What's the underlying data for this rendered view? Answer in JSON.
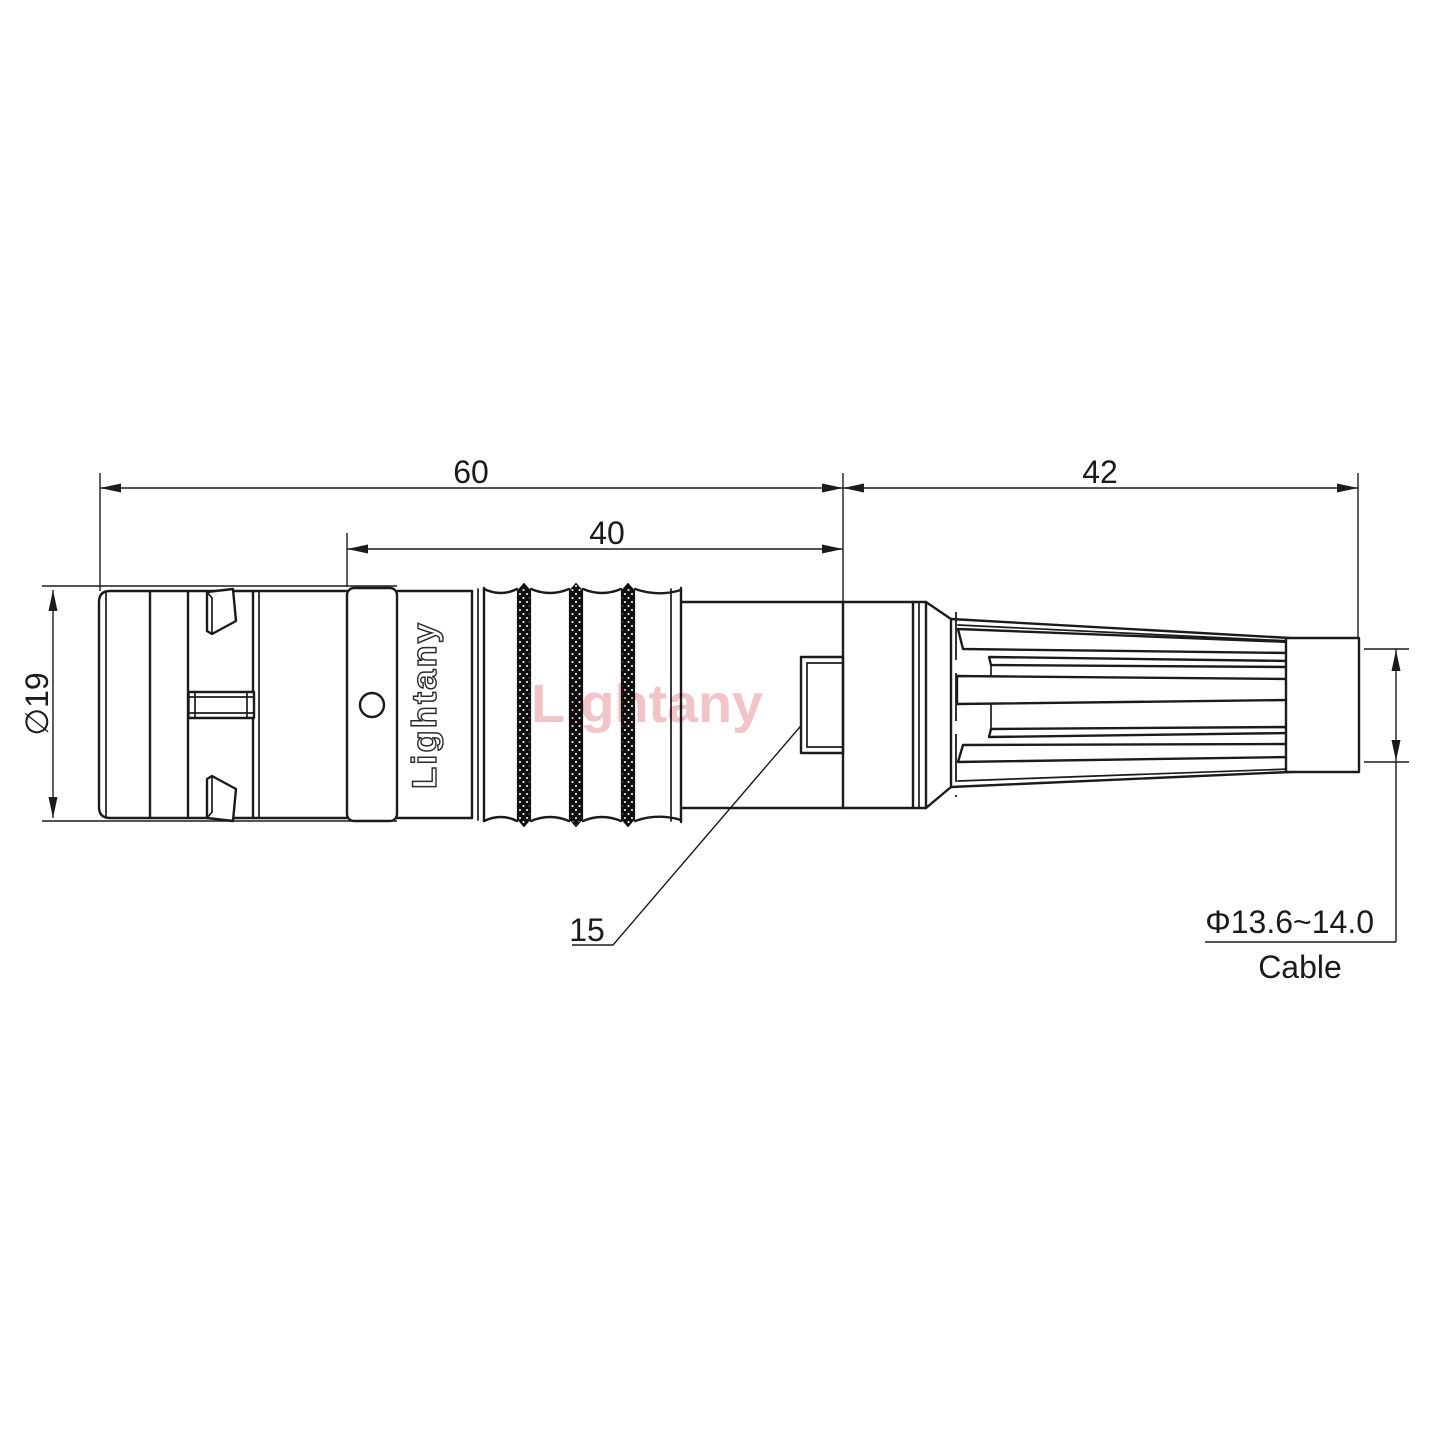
{
  "drawing": {
    "logo": "Lightany",
    "watermark": "Lightany",
    "dimensions": {
      "overall_length": "60",
      "body_length": "40",
      "boot_length": "42",
      "shell_diameter": "∅19",
      "clamp_width": "15",
      "cable_diameter": "Φ13.6~14.0",
      "cable_label": "Cable"
    },
    "colors": {
      "line": "#1b1b1b",
      "watermark_pink": "#f2c3c7"
    }
  }
}
